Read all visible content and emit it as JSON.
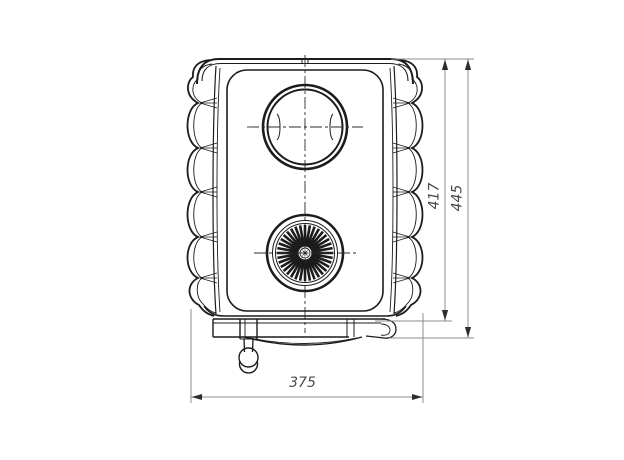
{
  "drawing": {
    "kind": "engineering-line-drawing",
    "view": "front-view-water-heater",
    "dimensions": [
      {
        "id": "body-height",
        "label": "417",
        "orientation": "vertical"
      },
      {
        "id": "overall-height",
        "label": "445",
        "orientation": "vertical"
      },
      {
        "id": "overall-width",
        "label": "375",
        "orientation": "horizontal"
      }
    ],
    "colors": {
      "background": "#ffffff",
      "drawing_line": "#1c1c1c",
      "dimension_line": "#8c8c8c",
      "dimension_text": "#4a4a4a",
      "arrowhead": "#2e2e2e"
    }
  }
}
